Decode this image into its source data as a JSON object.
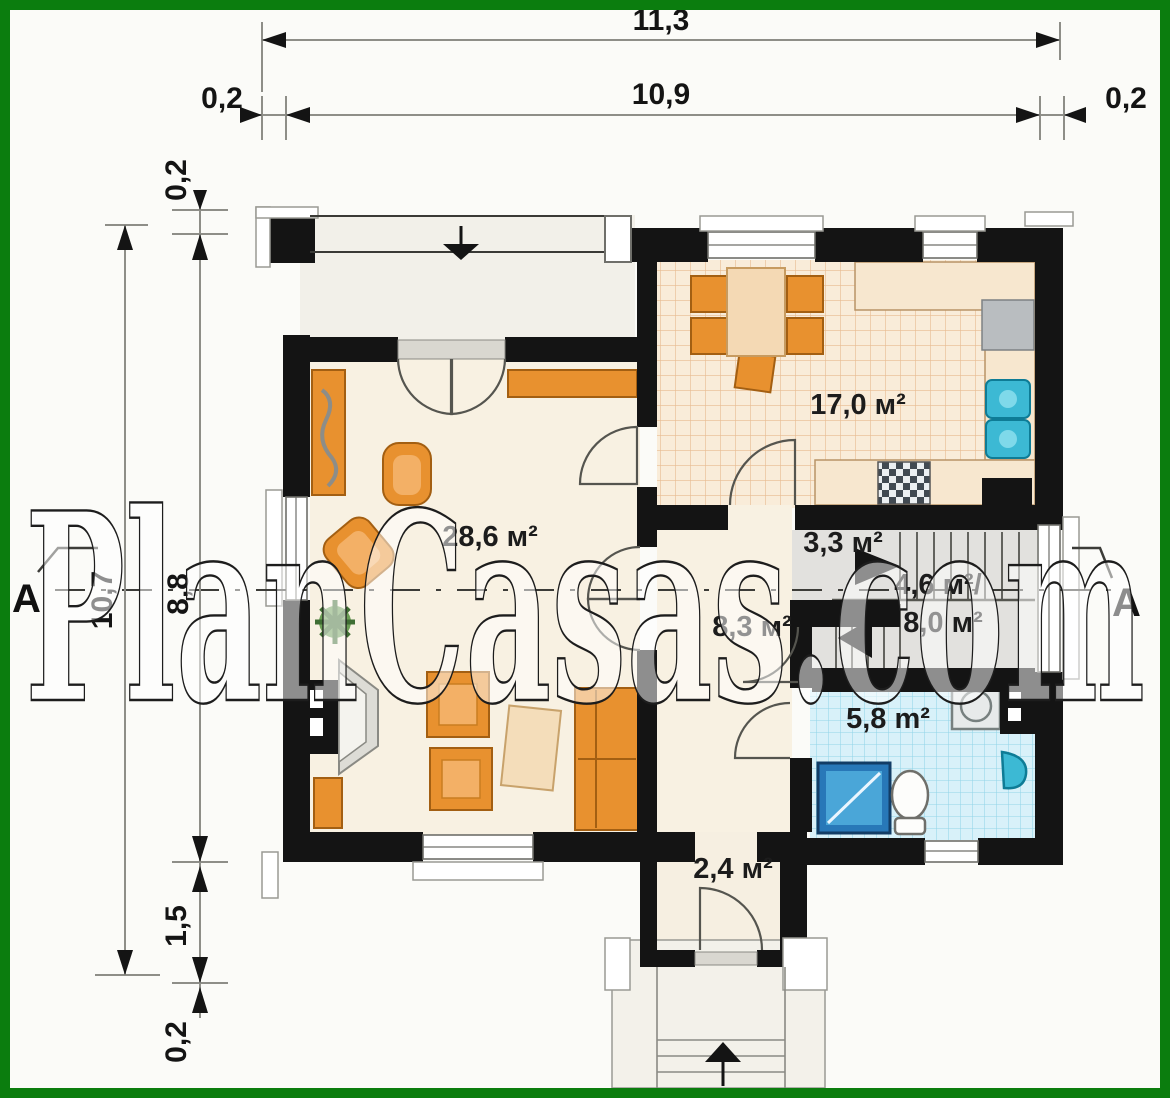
{
  "watermark": {
    "text": "PlanCasas.com"
  },
  "dimensions": {
    "top_total": "11,3",
    "top_inner": "10,9",
    "top_left_offset": "0,2",
    "top_right_offset": "0,2",
    "left_total": "10,7",
    "left_top_offset": "0,2",
    "left_main": "8,8",
    "left_lower": "1,5",
    "left_bottom_offset": "0,2"
  },
  "section": {
    "left": "A",
    "right": "A"
  },
  "rooms": {
    "kitchen": {
      "area": "17,0 м²"
    },
    "living": {
      "area": "28,6 м²"
    },
    "pantry": {
      "area": "3,3 м²"
    },
    "stairs": {
      "area_line1": "4,6 м²/",
      "area_line2": "8,0 м²"
    },
    "hall": {
      "area": "8,3 м²"
    },
    "bathroom": {
      "area": "5,8 m²"
    },
    "vestibule": {
      "area": "2,4 м²"
    }
  },
  "colors": {
    "frame_green": "#0b7d0e",
    "wall_black": "#151515",
    "floor_cream": "#f8f1e2",
    "kitchen_tile": "#f9ecd9",
    "bath_tile": "#d8f1f9",
    "furniture_orange": "#e8912f",
    "fixture_teal": "#3cb9d4"
  }
}
